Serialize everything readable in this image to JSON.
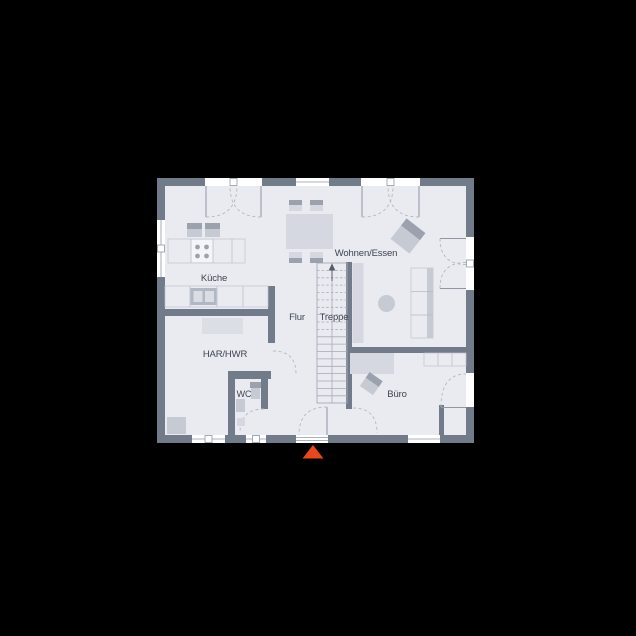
{
  "rooms": {
    "kueche": "Küche",
    "wohnen_essen": "Wohnen/Essen",
    "flur": "Flur",
    "treppe": "Treppe",
    "har_hwr": "HAR/HWR",
    "wc": "WC",
    "buero": "Büro"
  },
  "icons": {
    "entrance_marker": "▲",
    "stairs_up_arrow": "↑"
  },
  "colors": {
    "background": "#000000",
    "wall": "#727b8a",
    "floor": "#e9ebf1",
    "opening": "#ffffff",
    "furniture_light": "#d5d8e0",
    "furniture_mid": "#c6cad3",
    "furniture_dark": "#9ba2ae",
    "fixture": "#b2b8c2",
    "arc": "#b3b8c2",
    "stair_line": "#a4abb7",
    "text": "#3f4450",
    "entrance_marker": "#e8481c"
  }
}
